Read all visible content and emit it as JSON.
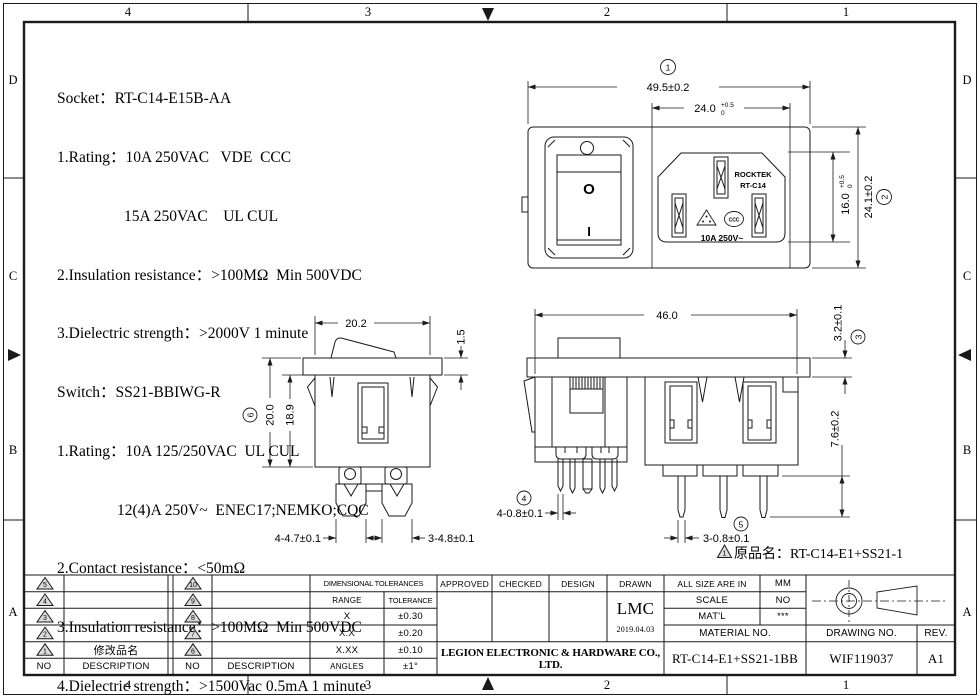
{
  "zones": {
    "top": [
      "4",
      "3",
      "2",
      "1"
    ],
    "bottom": [
      "4",
      "3",
      "2",
      "1"
    ],
    "left": [
      "D",
      "C",
      "B",
      "A"
    ],
    "right": [
      "D",
      "C",
      "B",
      "A"
    ]
  },
  "specs": {
    "lines": [
      "Socket：RT-C14-E15B-AA",
      "1.Rating：10A 250VAC   VDE  CCC",
      "15A 250VAC    UL CUL",
      "2.Insulation resistance：>100MΩ  Min 500VDC",
      "3.Dielectric strength：>2000V 1 minute",
      "Switch：SS21-BBIWG-R",
      "1.Rating：10A 125/250VAC  UL CUL",
      "12(4)A 250V~  ENEC17;NEMKO;CQC",
      "2.Contact resistance：<50mΩ",
      "3.Insulation resistance：>100MΩ  Min 500VDC",
      "4.Dielectric strength：>1500Vac 0.5mA 1 minute"
    ]
  },
  "front_view": {
    "ref1": "1",
    "dim_width": "49.5±0.2",
    "dim_opening": "24.0",
    "dim_opening_tol_up": "+0.5",
    "dim_opening_tol_dn": "0",
    "dim_inlet": "16.0",
    "dim_inlet_tol_up": "+0.5",
    "dim_inlet_tol_dn": "0",
    "ref2": "2",
    "dim_height": "24.1±0.2",
    "brand": "ROCKTEK",
    "model": "RT-C14",
    "rating": "10A 250V~",
    "cert": "CCC",
    "off_symbol": "O",
    "on_symbol": "I"
  },
  "switch_view": {
    "dim_width": "20.2",
    "dim_flange": "1.5",
    "ref6": "6",
    "dim_height": "20.0",
    "dim_body": "18.9",
    "dim_pins_a": "4-4.7±0.1",
    "dim_pins_b": "3-4.8±0.1"
  },
  "assembly_view": {
    "dim_width": "46.0",
    "ref3": "3",
    "dim_flange": "3.2±0.1",
    "dim_pin_len": "7.6±0.2",
    "ref4": "4",
    "dim_pins_a": "4-0.8±0.1",
    "ref5": "5",
    "dim_pins_b": "3-0.8±0.1",
    "note_ref": "1",
    "note": "原品名：RT-C14-E1+SS21-1"
  },
  "revision_table": {
    "left": {
      "nos": [
        "5",
        "4",
        "3",
        "2",
        "1"
      ],
      "descs": [
        "",
        "",
        "",
        "",
        "修改品名"
      ],
      "no_header": "NO",
      "desc_header": "DESCRIPTION"
    },
    "right": {
      "nos": [
        "10",
        "9",
        "8",
        "7",
        "6"
      ],
      "descs": [
        "",
        "",
        "",
        "",
        ""
      ],
      "no_header": "NO",
      "desc_header": "DESCRIPTION"
    }
  },
  "tolerance_table": {
    "title": "DIMENSIONAL TOLERANCES",
    "col1": "RANGE",
    "col2": "TOLERANCE",
    "rows": [
      [
        "X",
        "±0.30"
      ],
      [
        "X.X",
        "±0.20"
      ],
      [
        "X.XX",
        "±0.10"
      ],
      [
        "ANGLES",
        "±1°"
      ]
    ]
  },
  "title_block": {
    "approved": "APPROVED",
    "checked": "CHECKED",
    "design": "DESIGN",
    "drawn": "DRAWN",
    "drawn_by": "LMC",
    "drawn_date": "2019.04.03",
    "company": "LEGION ELECTRONIC & HARDWARE CO., LTD.",
    "all_size_label": "ALL SIZE ARE IN",
    "unit": "MM",
    "scale_label": "SCALE",
    "scale": "NO",
    "matl_label": "MAT'L",
    "matl": "***",
    "material_no_label": "MATERIAL NO.",
    "material_no": "RT-C14-E1+SS21-1BB",
    "drawing_no_label": "DRAWING NO.",
    "drawing_no": "WIF119037",
    "rev_label": "REV.",
    "rev": "A1"
  }
}
